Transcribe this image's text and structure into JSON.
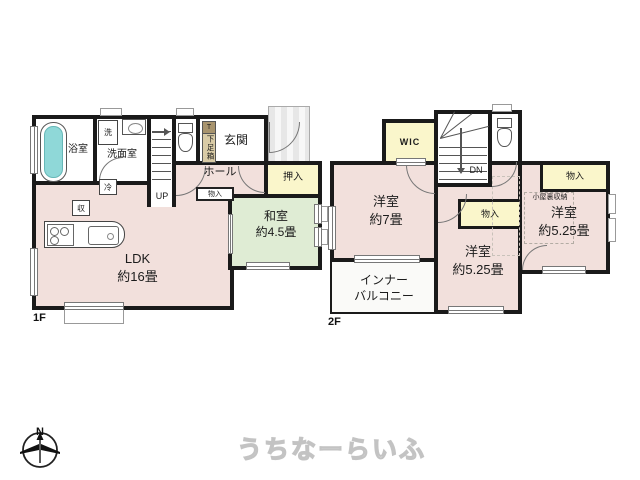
{
  "watermark": "うちなーらいふ",
  "compass": {
    "north": "N"
  },
  "f1": {
    "floor_label": "1F",
    "ldk_name": "LDK",
    "ldk_size": "約16畳",
    "washitsu_name": "和室",
    "washitsu_size": "約4.5畳",
    "bath": "浴室",
    "washroom": "洗面室",
    "laundry": "洗",
    "entrance": "玄関",
    "hall": "ホール",
    "shoebox_top": "T",
    "shoebox": "下足箱",
    "oshiire": "押入",
    "monoire": "物入",
    "fridge": "冷",
    "storage": "収",
    "up": "UP"
  },
  "f2": {
    "floor_label": "2F",
    "wic": "WIC",
    "dn": "DN",
    "room7_name": "洋室",
    "room7_size": "約7畳",
    "balcony_line1": "インナー",
    "balcony_line2": "バルコニー",
    "room525c_name": "洋室",
    "room525c_size": "約5.25畳",
    "room525r_name": "洋室",
    "room525r_size": "約5.25畳",
    "monoire_center": "物入",
    "monoire_right": "物入",
    "attic": "小屋裏収納"
  },
  "colors": {
    "wall": "#1a1a1a",
    "room_pink": "#f2e0dc",
    "tatami_green": "#dfecd4",
    "closet_yellow": "#faf6cb",
    "tub_cyan": "#8fd8d8",
    "balcony": "#fafaf8"
  }
}
